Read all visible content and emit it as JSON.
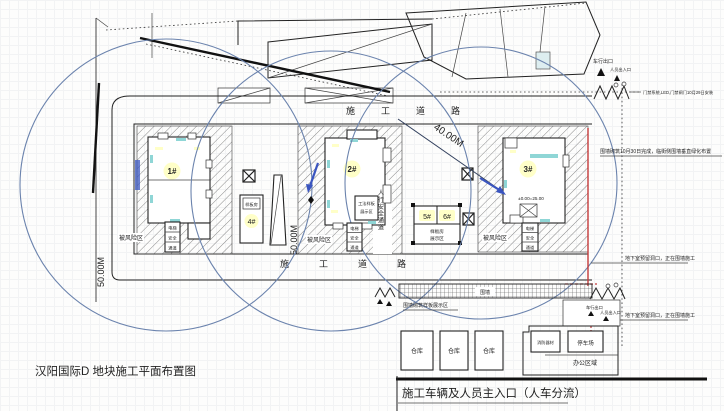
{
  "title": {
    "caption": "汉阳国际D 地块施工平面布置图"
  },
  "roads": {
    "top": "施工道路",
    "bottom": "施工道路"
  },
  "buildings": {
    "b1": "1#",
    "b2": "2#",
    "b3": "3#",
    "b4": "4#",
    "b5": "5#",
    "b6": "6#",
    "b3_elevation": "±0.00=25.00",
    "b4_note": "样板房",
    "b56_note1": "样板房",
    "b56_note2": "展示区"
  },
  "dimensions": {
    "west": "50.00M",
    "mid": "50.00M",
    "diagonal": "40.00M"
  },
  "risk_zones": {
    "z1": "被风险区",
    "z2": "被风险区",
    "z3": "被风险区"
  },
  "passage": {
    "c1": "电梯",
    "c2": "安全",
    "c3": "通道"
  },
  "corridor": {
    "vertical_label": "人行安全通道"
  },
  "sample_box": {
    "line1": "工法样板",
    "line2": "展示区"
  },
  "gates": {
    "north": {
      "vehicle": "车行出口",
      "pedestrian": "人员出入口",
      "note": "门禁系统,LED,门禁闸门10月29日安装"
    },
    "south": {
      "vehicle": "车行出口",
      "pedestrian": "人员出入口"
    }
  },
  "notes": {
    "wall": "围墙砌筑10月30日完成，临街侧围墙垂直绿化布置",
    "basement1": "地下室预留洞口，正在围墙施工",
    "basement2": "地下室预留洞口，正在围墙施工",
    "fence_chip": "围墙",
    "fence_sample": "围墙砌筑样板展示区"
  },
  "office": {
    "w1": "仓库",
    "w2": "仓库",
    "w3": "仓库",
    "fire_box": "消防器材",
    "parking_box": "停车场",
    "area": "办公区域"
  },
  "entrance": {
    "caption": "施工车辆及人员主入口（人车分流）"
  },
  "icons": {
    "tower_crane_icon": "⊠",
    "entrance_arrow_icon": "▲",
    "gate_icon": "WWW"
  },
  "colors": {
    "crane_radius": "#6b83ad",
    "red_line": "#c43b3b",
    "label_yellow": "#ffffc8",
    "accent_cyan": "#8fd6d6",
    "accent_blue": "#3a55c0"
  }
}
